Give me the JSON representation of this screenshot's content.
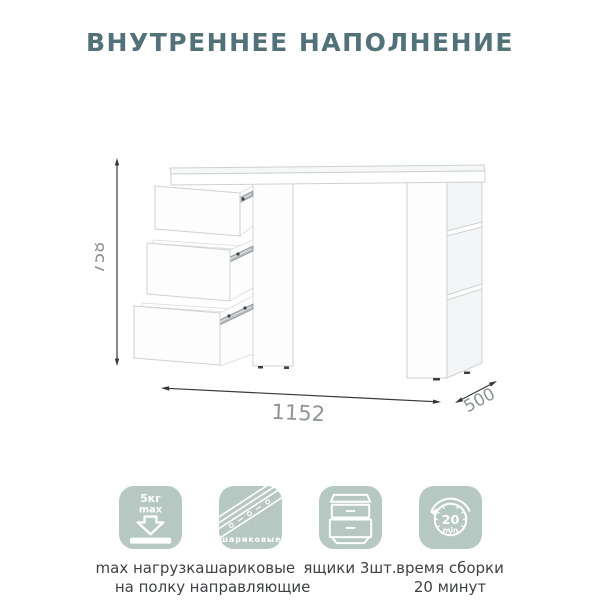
{
  "title": "ВНУТРЕННЕЕ НАПОЛНЕНИЕ",
  "dimensions": {
    "height": "758",
    "width": "1152",
    "depth": "500"
  },
  "features": [
    {
      "icon": "shelf-load-icon",
      "icon_text_line1": "5кг",
      "icon_text_line2": "max",
      "label_line1": "max нагрузка",
      "label_line2": "на полку"
    },
    {
      "icon": "drawer-slides-icon",
      "icon_caption": "шариковые",
      "label_line1": "шариковые",
      "label_line2": "направляющие"
    },
    {
      "icon": "drawers-icon",
      "label_line1": "ящики 3шт.",
      "label_line2": ""
    },
    {
      "icon": "assembly-time-icon",
      "icon_text_line1": "20",
      "icon_text_line2": "min",
      "label_line1": "время сборки",
      "label_line2": "20 минут"
    }
  ],
  "colors": {
    "title": "#527179",
    "icon_background": "#b7c8c3",
    "icon_glyph": "#ffffff",
    "label_text": "#3e4244",
    "dimension_text": "#8d9396",
    "dimension_line": "#34393c"
  }
}
